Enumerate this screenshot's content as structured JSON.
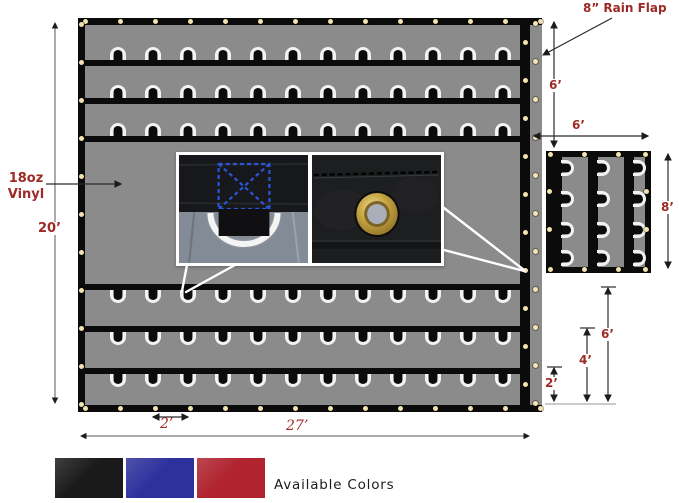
{
  "labels": {
    "material_line1": "18oz",
    "material_line2": "Vinyl",
    "rain_flap": "8” Rain Flap",
    "tarp_height": "20’",
    "tarp_width": "27’",
    "ring_spacing": "2’",
    "flap_to_panel_gap": "6’",
    "panel_width": "6’",
    "panel_height": "8’",
    "strap_from_bottom_2ft": "2’",
    "strap_from_bottom_4ft": "4’",
    "strap_from_bottom_6ft": "6’",
    "available_colors": "Available Colors"
  },
  "structure": {
    "top_strap_rows": 3,
    "bottom_strap_rows": 3,
    "d_rings_per_row": 12,
    "side_panel_straps": 3,
    "side_panel_rings_per_strap": 4
  },
  "swatches": [
    {
      "name": "black",
      "hex": "#1a1a1a"
    },
    {
      "name": "blue",
      "hex": "#2e319b"
    },
    {
      "name": "red",
      "hex": "#b0232f"
    }
  ],
  "palette": {
    "tarp_gray": "#8b8b8b",
    "strap_black": "#0b0b0b",
    "grommet_cream": "#f2e3b0",
    "dimension_red": "#9d2a24",
    "brass_gold": "#c7a544",
    "stitch_blue": "#2a55d4"
  }
}
